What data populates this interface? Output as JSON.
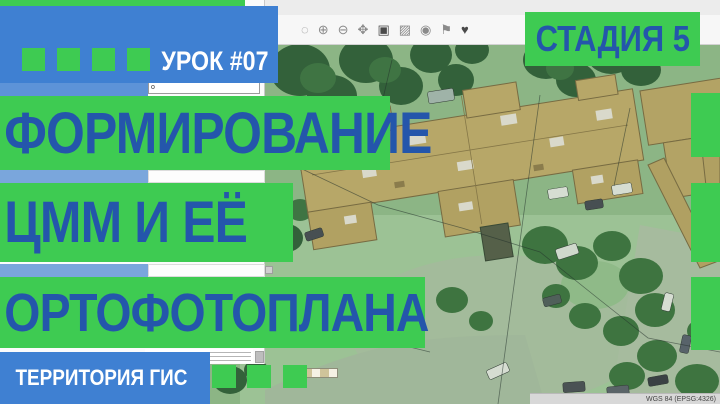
{
  "overlay": {
    "lesson_badge": "УРОК #07",
    "stage_badge": "СТАДИЯ 5",
    "title_lines": [
      "ФОРМИРОВАНИЕ",
      "ЦММ И ЕЁ",
      "ОРТОФОТОПЛАНА"
    ],
    "brand": "ТЕРРИТОРИЯ ГИС",
    "accent_green": "#3ecb52",
    "accent_blue": "#3f80d2",
    "title_blue": "#2456ab"
  },
  "toolbar": {
    "icons": [
      {
        "name": "selection-circle-icon",
        "glyph": "◌"
      },
      {
        "name": "zoom-in-icon",
        "glyph": "⊕"
      },
      {
        "name": "zoom-out-icon",
        "glyph": "⊖"
      },
      {
        "name": "pan-icon",
        "glyph": "✥"
      },
      {
        "name": "image-icon",
        "glyph": "▣"
      },
      {
        "name": "image-outline-icon",
        "glyph": "▨"
      },
      {
        "name": "camera-icon",
        "glyph": "◉"
      },
      {
        "name": "flag-icon",
        "glyph": "⚑"
      },
      {
        "name": "heart-icon",
        "glyph": "♥"
      }
    ]
  },
  "panel": {
    "input_value": "o"
  },
  "statusbar": {
    "crs": "WGS 84 (EPSG:4326)"
  }
}
